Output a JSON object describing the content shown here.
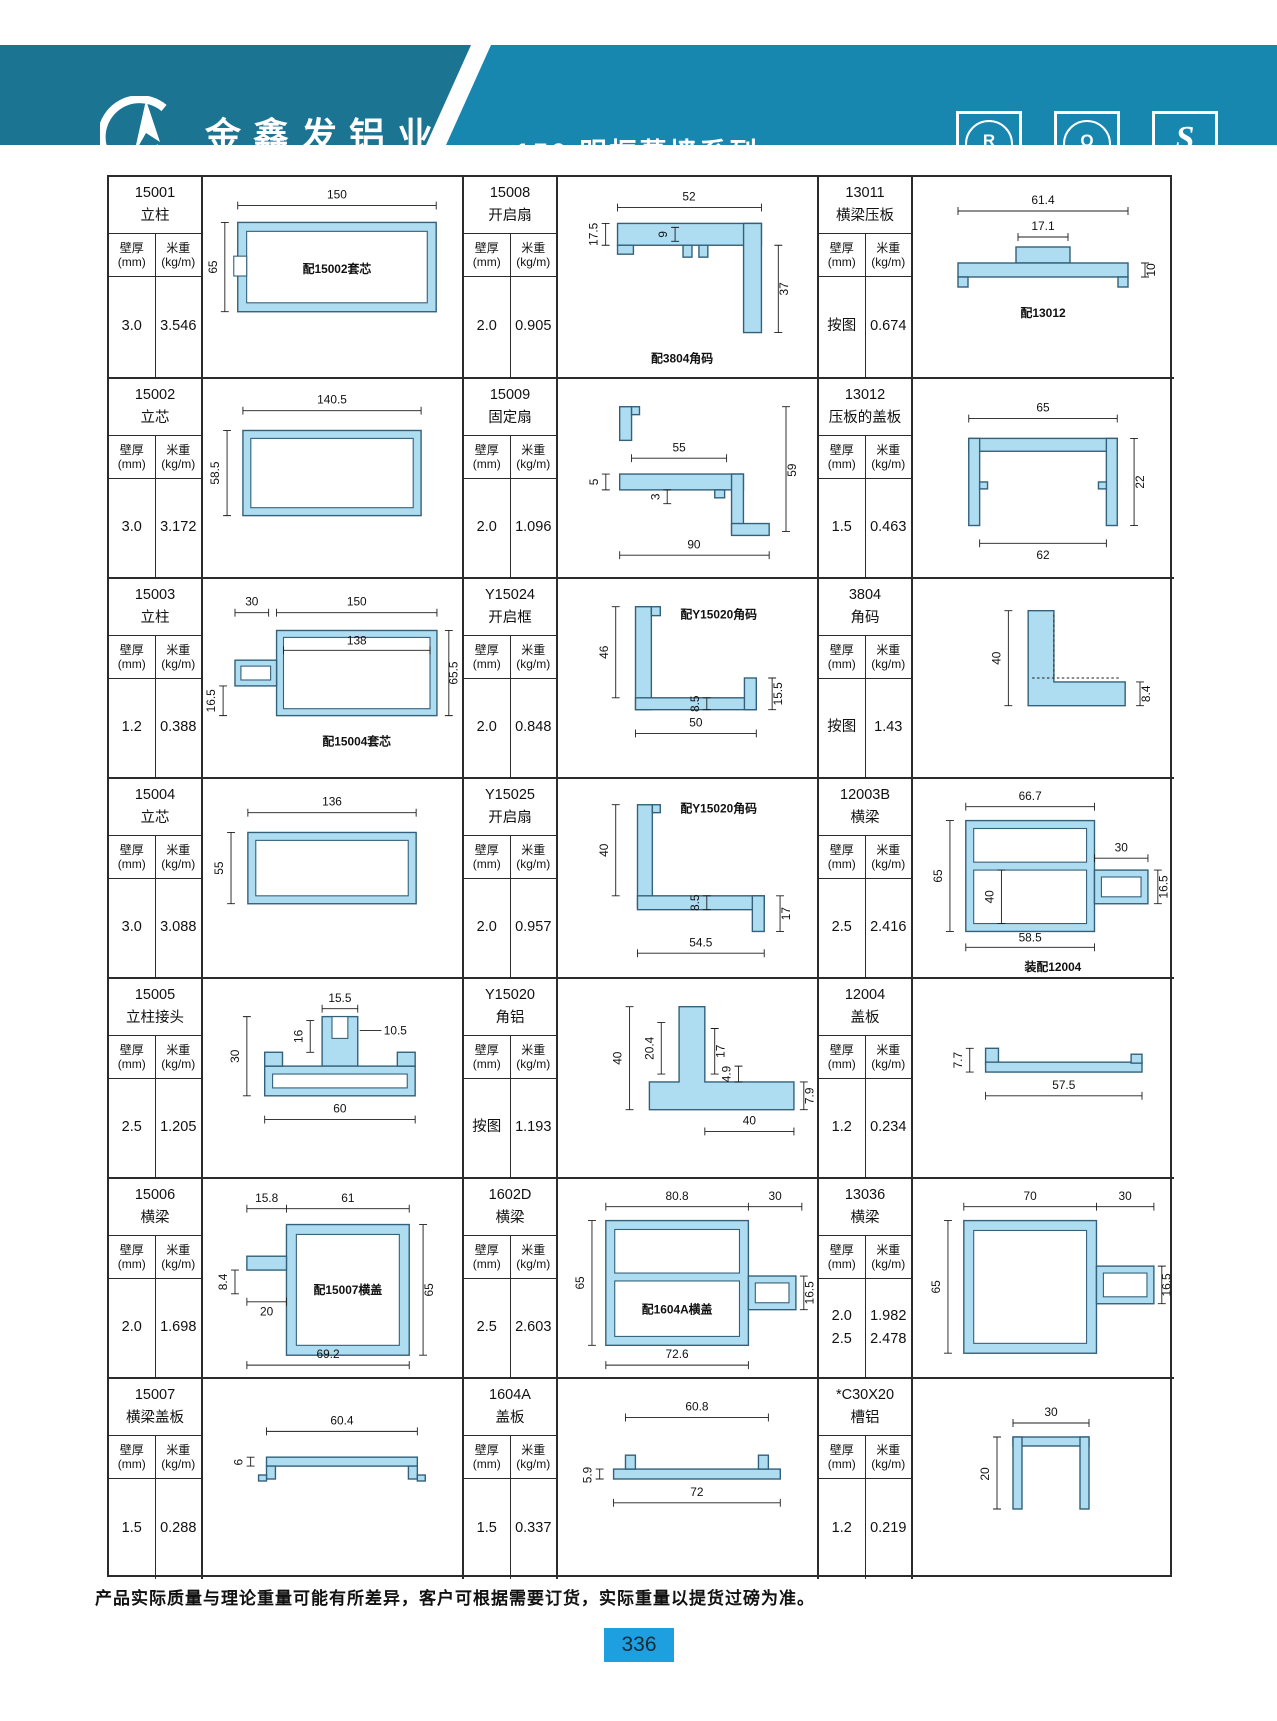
{
  "header": {
    "company_cn": "金鑫发铝业",
    "company_en": "JINXINFA ALUMINUM",
    "series_title": "150 明框幕墙系列",
    "arrow": "↘",
    "badges": [
      {
        "symbol": "R",
        "caption": "CQM"
      },
      {
        "symbol": "Q",
        "caption": "CQM"
      },
      {
        "symbol": "S",
        "caption": "生产许可"
      }
    ]
  },
  "labels": {
    "thickness": "壁厚\n(mm)",
    "weight": "米重\n(kg/m)"
  },
  "colors": {
    "header_dark": "#1a7492",
    "header_light": "#1887b0",
    "profile_fill": "#aedcf1",
    "page_tab": "#1d9fe0"
  },
  "cells": [
    {
      "code": "15001",
      "name": "立柱",
      "thickness": "3.0",
      "weight": "3.546",
      "note": "配15002套芯",
      "dims": {
        "w": "150",
        "h": "65"
      }
    },
    {
      "code": "15008",
      "name": "开启扇",
      "thickness": "2.0",
      "weight": "0.905",
      "note": "配3804角码",
      "dims": {
        "w": "52",
        "h1": "17.5",
        "i": "9",
        "h2": "37"
      }
    },
    {
      "code": "13011",
      "name": "横梁压板",
      "thickness": "按图",
      "weight": "0.674",
      "note": "配13012",
      "dims": {
        "w": "61.4",
        "wi": "17.1",
        "h": "10"
      }
    },
    {
      "code": "15002",
      "name": "立芯",
      "thickness": "3.0",
      "weight": "3.172",
      "dims": {
        "w": "140.5",
        "h": "58.5"
      }
    },
    {
      "code": "15009",
      "name": "固定扇",
      "thickness": "2.0",
      "weight": "1.096",
      "dims": {
        "w": "55",
        "a": "5",
        "b": "3",
        "h": "59",
        "wb": "90"
      }
    },
    {
      "code": "13012",
      "name": "压板的盖板",
      "thickness": "1.5",
      "weight": "0.463",
      "dims": {
        "w": "65",
        "wb": "62",
        "h": "22"
      }
    },
    {
      "code": "15003",
      "name": "立柱",
      "thickness": "1.2",
      "weight": "0.388",
      "note": "配15004套芯",
      "dims": {
        "w1": "30",
        "w": "150",
        "wi": "138",
        "h": "65.5",
        "h2": "16.5"
      }
    },
    {
      "code": "Y15024",
      "name": "开启框",
      "thickness": "2.0",
      "weight": "0.848",
      "note": "配Y15020角码",
      "dims": {
        "h": "46",
        "t": "8.5",
        "h2": "15.5",
        "wb": "50"
      }
    },
    {
      "code": "3804",
      "name": "角码",
      "thickness": "按图",
      "weight": "1.43",
      "dims": {
        "h": "40",
        "t": "8.4"
      }
    },
    {
      "code": "15004",
      "name": "立芯",
      "thickness": "3.0",
      "weight": "3.088",
      "dims": {
        "w": "136",
        "h": "55"
      }
    },
    {
      "code": "Y15025",
      "name": "开启扇",
      "thickness": "2.0",
      "weight": "0.957",
      "note": "配Y15020角码",
      "dims": {
        "h": "40",
        "t": "8.5",
        "h2": "17",
        "wb": "54.5"
      }
    },
    {
      "code": "12003B",
      "name": "横梁",
      "thickness": "2.5",
      "weight": "2.416",
      "note": "装配12004",
      "dims": {
        "w": "66.7",
        "w2": "30",
        "h": "65",
        "hi": "40",
        "h2": "16.5",
        "wb": "58.5"
      }
    },
    {
      "code": "15005",
      "name": "立柱接头",
      "thickness": "2.5",
      "weight": "1.205",
      "dims": {
        "w": "15.5",
        "hi": "16",
        "wi": "10.5",
        "h": "30",
        "wb": "60"
      }
    },
    {
      "code": "Y15020",
      "name": "角铝",
      "thickness": "按图",
      "weight": "1.193",
      "dims": {
        "h": "40",
        "a": "20.4",
        "b": "17",
        "c": "4.9",
        "d": "7.9",
        "wb": "40"
      }
    },
    {
      "code": "12004",
      "name": "盖板",
      "thickness": "1.2",
      "weight": "0.234",
      "dims": {
        "h": "7.7",
        "wb": "57.5"
      }
    },
    {
      "code": "15006",
      "name": "横梁",
      "thickness": "2.0",
      "weight": "1.698",
      "note": "配15007横盖",
      "dims": {
        "w1": "15.8",
        "w": "61",
        "h": "65",
        "t": "8.4",
        "wi": "20",
        "wb": "69.2"
      }
    },
    {
      "code": "1602D",
      "name": "横梁",
      "thickness": "2.5",
      "weight": "2.603",
      "note": "配1604A横盖",
      "dims": {
        "w": "80.8",
        "w2": "30",
        "h": "65",
        "h2": "16.5",
        "wb": "72.6"
      }
    },
    {
      "code": "13036",
      "name": "横梁",
      "thickness": "2.0\n2.5",
      "weight": "1.982\n2.478",
      "dims": {
        "w": "70",
        "w2": "30",
        "h": "65",
        "h2": "16.5"
      }
    },
    {
      "code": "15007",
      "name": "横梁盖板",
      "thickness": "1.5",
      "weight": "0.288",
      "dims": {
        "w": "60.4",
        "t": "6"
      }
    },
    {
      "code": "1604A",
      "name": "盖板",
      "thickness": "1.5",
      "weight": "0.337",
      "dims": {
        "w": "60.8",
        "t": "5.9",
        "wb": "72"
      }
    },
    {
      "code": "*C30X20",
      "name": "槽铝",
      "thickness": "1.2",
      "weight": "0.219",
      "dims": {
        "w": "30",
        "h": "20"
      }
    }
  ],
  "footer": {
    "note": "产品实际质量与理论重量可能有所差异，客户可根据需要订货，实际重量以提货过磅为准。",
    "page": "336"
  }
}
